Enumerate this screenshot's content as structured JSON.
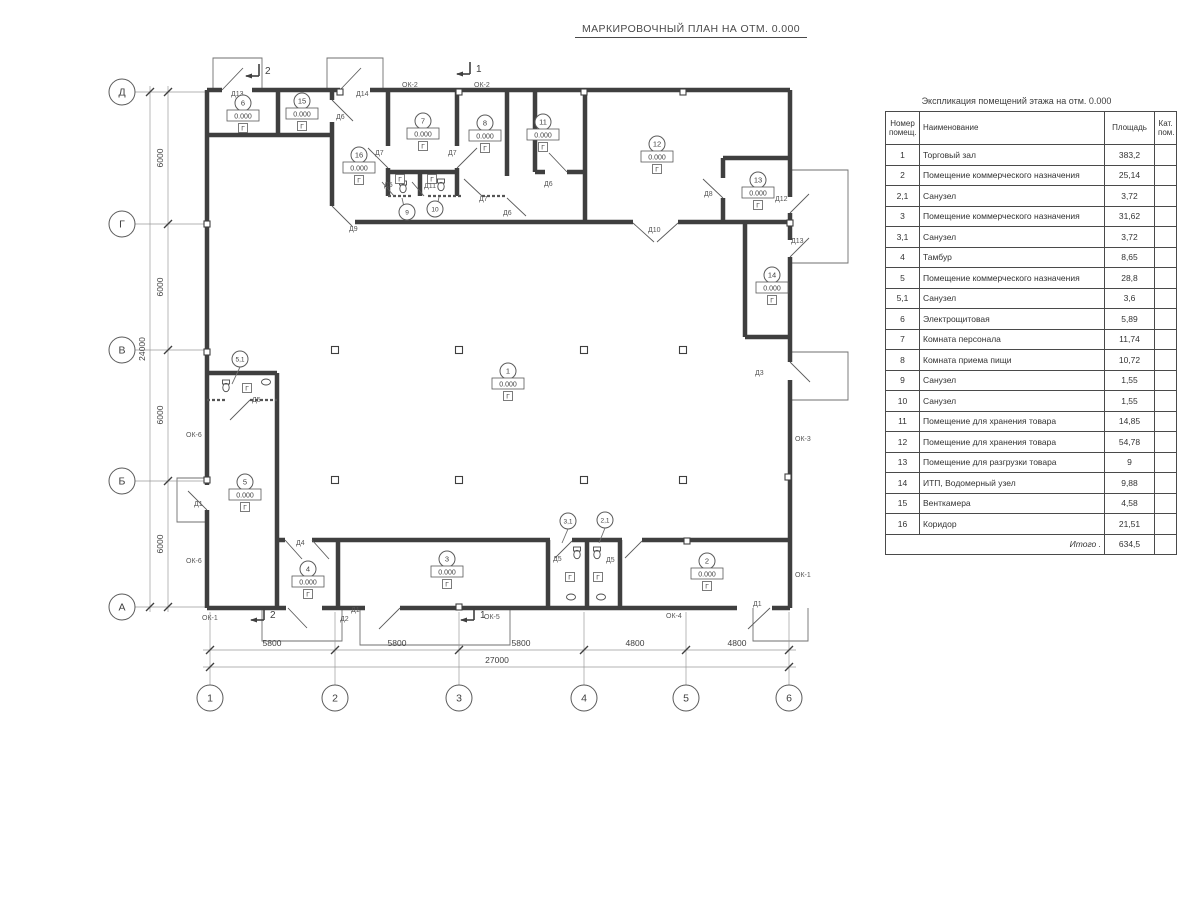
{
  "title": "МАРКИРОВОЧНЫЙ ПЛАН НА ОТМ. 0.000",
  "schedule": {
    "title": "Экспликация помещений этажа на отм. 0.000",
    "headers": {
      "num": "Номер\nпомещ.",
      "name": "Наименование",
      "area": "Площадь",
      "cat": "Кат.\nпом."
    },
    "rows": [
      [
        "1",
        "Торговый зал",
        "383,2"
      ],
      [
        "2",
        "Помещение коммерческого назначения",
        "25,14"
      ],
      [
        "2,1",
        "Санузел",
        "3,72"
      ],
      [
        "3",
        "Помещение коммерческого назначения",
        "31,62"
      ],
      [
        "3,1",
        "Санузел",
        "3,72"
      ],
      [
        "4",
        "Тамбур",
        "8,65"
      ],
      [
        "5",
        "Помещение коммерческого назначения",
        "28,8"
      ],
      [
        "5,1",
        "Санузел",
        "3,6"
      ],
      [
        "6",
        "Электрощитовая",
        "5,89"
      ],
      [
        "7",
        "Комната персонала",
        "11,74"
      ],
      [
        "8",
        "Комната приема пищи",
        "10,72"
      ],
      [
        "9",
        "Санузел",
        "1,55"
      ],
      [
        "10",
        "Санузел",
        "1,55"
      ],
      [
        "11",
        "Помещение для хранения товара",
        "14,85"
      ],
      [
        "12",
        "Помещение для хранения товара",
        "54,78"
      ],
      [
        "13",
        "Помещение для разгрузки товара",
        "9"
      ],
      [
        "14",
        "ИТП, Водомерный узел",
        "9,88"
      ],
      [
        "15",
        "Венткамера",
        "4,58"
      ],
      [
        "16",
        "Коридор",
        "21,51"
      ]
    ],
    "total_label": "Итого .",
    "total_value": "634,5"
  },
  "plan": {
    "elevation_text": "0.000",
    "floor_mark": "Г",
    "walls": [
      [
        207,
        90,
        222,
        90
      ],
      [
        252,
        90,
        340,
        90
      ],
      [
        370,
        90,
        790,
        90
      ],
      [
        207,
        90,
        207,
        485
      ],
      [
        207,
        510,
        207,
        608
      ],
      [
        207,
        608,
        286,
        608
      ],
      [
        322,
        608,
        365,
        608
      ],
      [
        400,
        608,
        737,
        608
      ],
      [
        772,
        608,
        790,
        608
      ],
      [
        790,
        90,
        790,
        197
      ],
      [
        790,
        213,
        790,
        240
      ],
      [
        790,
        257,
        790,
        362
      ],
      [
        790,
        380,
        790,
        608
      ],
      [
        207,
        135,
        332,
        135
      ],
      [
        278,
        90,
        278,
        135
      ],
      [
        332,
        90,
        332,
        100
      ],
      [
        332,
        122,
        332,
        206
      ],
      [
        388,
        90,
        388,
        146
      ],
      [
        388,
        168,
        388,
        196
      ],
      [
        457,
        90,
        457,
        146
      ],
      [
        457,
        168,
        457,
        196
      ],
      [
        507,
        90,
        507,
        176
      ],
      [
        535,
        90,
        535,
        172
      ],
      [
        585,
        90,
        585,
        223
      ],
      [
        388,
        172,
        457,
        172
      ],
      [
        420,
        172,
        420,
        196
      ],
      [
        535,
        172,
        545,
        172
      ],
      [
        567,
        172,
        585,
        172
      ],
      [
        355,
        222,
        633,
        222
      ],
      [
        678,
        222,
        790,
        222
      ],
      [
        723,
        158,
        723,
        178
      ],
      [
        723,
        198,
        723,
        222
      ],
      [
        723,
        158,
        790,
        158
      ],
      [
        745,
        222,
        745,
        337
      ],
      [
        745,
        337,
        790,
        337
      ],
      [
        207,
        373,
        277,
        373
      ],
      [
        277,
        373,
        277,
        608
      ],
      [
        277,
        540,
        285,
        540
      ],
      [
        312,
        540,
        550,
        540
      ],
      [
        572,
        540,
        622,
        540
      ],
      [
        642,
        540,
        790,
        540
      ],
      [
        338,
        540,
        338,
        608
      ],
      [
        548,
        540,
        548,
        608
      ],
      [
        587,
        540,
        587,
        608
      ],
      [
        620,
        540,
        620,
        608
      ]
    ],
    "dotted_walls": [
      [
        388,
        196,
        412,
        196
      ],
      [
        428,
        196,
        462,
        196
      ],
      [
        482,
        196,
        507,
        196
      ],
      [
        207,
        400,
        225,
        400
      ],
      [
        250,
        400,
        277,
        400
      ]
    ],
    "windows": [
      [
        397,
        90,
        427,
        90
      ],
      [
        470,
        90,
        498,
        90
      ],
      [
        207,
        418,
        207,
        466
      ],
      [
        207,
        545,
        207,
        592
      ],
      [
        790,
        398,
        790,
        538
      ],
      [
        790,
        552,
        790,
        597
      ],
      [
        216,
        608,
        260,
        608
      ],
      [
        443,
        608,
        560,
        608
      ],
      [
        630,
        608,
        700,
        608
      ]
    ],
    "porches": [
      [
        [
          213,
          90
        ],
        [
          213,
          58
        ],
        [
          262,
          58
        ],
        [
          262,
          90
        ]
      ],
      [
        [
          327,
          90
        ],
        [
          327,
          58
        ],
        [
          383,
          58
        ],
        [
          383,
          90
        ]
      ],
      [
        [
          790,
          170
        ],
        [
          848,
          170
        ],
        [
          848,
          263
        ],
        [
          790,
          263
        ]
      ],
      [
        [
          790,
          352
        ],
        [
          848,
          352
        ],
        [
          848,
          400
        ],
        [
          790,
          400
        ]
      ],
      [
        [
          207,
          478
        ],
        [
          177,
          478
        ],
        [
          177,
          522
        ],
        [
          207,
          522
        ]
      ],
      [
        [
          262,
          608
        ],
        [
          262,
          641
        ],
        [
          342,
          641
        ],
        [
          342,
          608
        ]
      ],
      [
        [
          360,
          608
        ],
        [
          360,
          645
        ],
        [
          510,
          645
        ],
        [
          510,
          608
        ]
      ],
      [
        [
          753,
          608
        ],
        [
          753,
          641
        ],
        [
          808,
          641
        ],
        [
          808,
          608
        ]
      ]
    ],
    "door_leaves": [
      [
        222,
        90,
        243,
        68
      ],
      [
        340,
        90,
        361,
        68
      ],
      [
        332,
        100,
        353,
        121
      ],
      [
        332,
        206,
        352,
        226
      ],
      [
        388,
        168,
        368,
        148
      ],
      [
        457,
        168,
        477,
        148
      ],
      [
        394,
        196,
        382,
        182
      ],
      [
        424,
        196,
        412,
        182
      ],
      [
        482,
        196,
        464,
        179
      ],
      [
        507,
        198,
        526,
        216
      ],
      [
        567,
        172,
        549,
        153
      ],
      [
        633,
        223,
        654,
        242
      ],
      [
        678,
        223,
        657,
        242
      ],
      [
        723,
        198,
        703,
        179
      ],
      [
        790,
        213,
        809,
        194
      ],
      [
        790,
        257,
        809,
        238
      ],
      [
        790,
        362,
        810,
        382
      ],
      [
        207,
        510,
        188,
        491
      ],
      [
        250,
        400,
        230,
        420
      ],
      [
        285,
        540,
        302,
        559
      ],
      [
        312,
        540,
        329,
        559
      ],
      [
        288,
        608,
        307,
        628
      ],
      [
        400,
        608,
        379,
        629
      ],
      [
        572,
        541,
        555,
        558
      ],
      [
        642,
        541,
        625,
        558
      ],
      [
        770,
        608,
        748,
        629
      ]
    ],
    "door_labels": [
      {
        "t": "Д13",
        "x": 231,
        "y": 96
      },
      {
        "t": "Д14",
        "x": 356,
        "y": 96
      },
      {
        "t": "Д6",
        "x": 336,
        "y": 119
      },
      {
        "t": "Д9",
        "x": 349,
        "y": 231
      },
      {
        "t": "Д7",
        "x": 375,
        "y": 155
      },
      {
        "t": "Д7",
        "x": 448,
        "y": 155
      },
      {
        "t": "Д5",
        "x": 384,
        "y": 187
      },
      {
        "t": "Д11",
        "x": 424,
        "y": 188
      },
      {
        "t": "Д7",
        "x": 479,
        "y": 201
      },
      {
        "t": "Д6",
        "x": 503,
        "y": 215
      },
      {
        "t": "Д6",
        "x": 544,
        "y": 186
      },
      {
        "t": "Д10",
        "x": 648,
        "y": 232
      },
      {
        "t": "Д8",
        "x": 704,
        "y": 196
      },
      {
        "t": "Д12",
        "x": 775,
        "y": 201
      },
      {
        "t": "Д13",
        "x": 791,
        "y": 243
      },
      {
        "t": "Д3",
        "x": 755,
        "y": 375
      },
      {
        "t": "Д1",
        "x": 194,
        "y": 506
      },
      {
        "t": "Д5",
        "x": 252,
        "y": 402
      },
      {
        "t": "Д4",
        "x": 296,
        "y": 545
      },
      {
        "t": "Д2",
        "x": 340,
        "y": 621
      },
      {
        "t": "Д1",
        "x": 351,
        "y": 612
      },
      {
        "t": "Д5",
        "x": 553,
        "y": 561
      },
      {
        "t": "Д5",
        "x": 606,
        "y": 562
      },
      {
        "t": "Д1",
        "x": 753,
        "y": 606
      }
    ],
    "window_labels": [
      {
        "t": "ОК-2",
        "x": 402,
        "y": 87
      },
      {
        "t": "ОК-2",
        "x": 474,
        "y": 87
      },
      {
        "t": "ОК-6",
        "x": 186,
        "y": 437
      },
      {
        "t": "ОК-6",
        "x": 186,
        "y": 563
      },
      {
        "t": "ОК-3",
        "x": 795,
        "y": 441
      },
      {
        "t": "ОК-1",
        "x": 795,
        "y": 577
      },
      {
        "t": "ОК-1",
        "x": 202,
        "y": 620
      },
      {
        "t": "ОК-5",
        "x": 484,
        "y": 619
      },
      {
        "t": "ОК-4",
        "x": 666,
        "y": 618
      }
    ],
    "markers": [
      {
        "n": "1",
        "x": 508,
        "y": 371
      },
      {
        "n": "2",
        "x": 707,
        "y": 561
      },
      {
        "n": "3",
        "x": 447,
        "y": 559
      },
      {
        "n": "4",
        "x": 308,
        "y": 569
      },
      {
        "n": "5",
        "x": 245,
        "y": 482
      },
      {
        "n": "6",
        "x": 243,
        "y": 103
      },
      {
        "n": "7",
        "x": 423,
        "y": 121
      },
      {
        "n": "8",
        "x": 485,
        "y": 123
      },
      {
        "n": "11",
        "x": 543,
        "y": 122
      },
      {
        "n": "12",
        "x": 657,
        "y": 144
      },
      {
        "n": "13",
        "x": 758,
        "y": 180
      },
      {
        "n": "14",
        "x": 772,
        "y": 275
      },
      {
        "n": "15",
        "x": 302,
        "y": 101
      },
      {
        "n": "16",
        "x": 359,
        "y": 155
      }
    ],
    "leader_markers": [
      {
        "n": "5,1",
        "cx": 240,
        "cy": 359,
        "lx": 232,
        "ly": 384,
        "gx": 247,
        "gy": 388
      },
      {
        "n": "9",
        "cx": 407,
        "cy": 212,
        "lx": 402,
        "ly": 198,
        "gx": 400,
        "gy": 179
      },
      {
        "n": "10",
        "cx": 435,
        "cy": 209,
        "lx": 439,
        "ly": 197,
        "gx": 432,
        "gy": 179
      },
      {
        "n": "3,1",
        "cx": 568,
        "cy": 521,
        "lx": 562,
        "ly": 543,
        "gx": 570,
        "gy": 577
      },
      {
        "n": "2,1",
        "cx": 605,
        "cy": 520,
        "lx": 599,
        "ly": 543,
        "gx": 598,
        "gy": 577
      }
    ],
    "columns": [
      [
        335,
        350
      ],
      [
        459,
        350
      ],
      [
        584,
        350
      ],
      [
        683,
        350
      ],
      [
        335,
        480
      ],
      [
        459,
        480
      ],
      [
        584,
        480
      ],
      [
        683,
        480
      ]
    ],
    "pilasters": [
      [
        340,
        92
      ],
      [
        459,
        92
      ],
      [
        584,
        92
      ],
      [
        683,
        92
      ],
      [
        207,
        224
      ],
      [
        207,
        352
      ],
      [
        207,
        480
      ],
      [
        790,
        223
      ],
      [
        788,
        477
      ],
      [
        459,
        607
      ],
      [
        687,
        541
      ]
    ],
    "toilets": [
      [
        403,
        190
      ],
      [
        441,
        188
      ],
      [
        226,
        389
      ],
      [
        577,
        556
      ],
      [
        597,
        556
      ]
    ],
    "sinks": [
      [
        266,
        382
      ],
      [
        571,
        597
      ],
      [
        601,
        597
      ]
    ],
    "axes_left": [
      {
        "label": "Д",
        "y": 92
      },
      {
        "label": "Г",
        "y": 224
      },
      {
        "label": "В",
        "y": 350
      },
      {
        "label": "Б",
        "y": 481
      },
      {
        "label": "А",
        "y": 607
      }
    ],
    "axes_bottom": [
      {
        "label": "1",
        "x": 210
      },
      {
        "label": "2",
        "x": 335
      },
      {
        "label": "3",
        "x": 459
      },
      {
        "label": "4",
        "x": 584
      },
      {
        "label": "5",
        "x": 686
      },
      {
        "label": "6",
        "x": 789
      }
    ],
    "dims_left": {
      "segments": [
        {
          "y": 158,
          "t": "6000"
        },
        {
          "y": 287,
          "t": "6000"
        },
        {
          "y": 415,
          "t": "6000"
        },
        {
          "y": 544,
          "t": "6000"
        }
      ],
      "total": {
        "y": 349,
        "t": "24000"
      }
    },
    "dims_bottom": {
      "segments": [
        {
          "x": 272,
          "t": "5800"
        },
        {
          "x": 397,
          "t": "5800"
        },
        {
          "x": 521,
          "t": "5800"
        },
        {
          "x": 635,
          "t": "4800"
        },
        {
          "x": 737,
          "t": "4800"
        }
      ],
      "total": {
        "x": 497,
        "t": "27000"
      }
    },
    "sections": [
      {
        "x": 259,
        "y": 73,
        "n": "2"
      },
      {
        "x": 470,
        "y": 71,
        "n": "1"
      },
      {
        "x": 264,
        "y": 617,
        "n": "2"
      },
      {
        "x": 474,
        "y": 617,
        "n": "1"
      }
    ]
  }
}
